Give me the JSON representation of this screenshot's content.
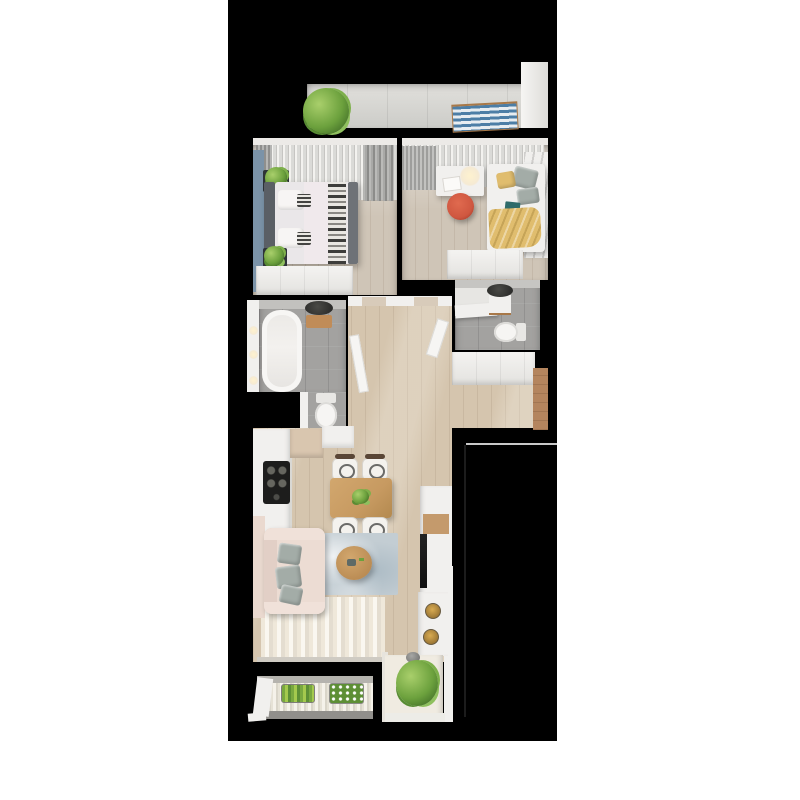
{
  "canvas": {
    "width": 800,
    "height": 800,
    "page_background": "#ffffff",
    "render_background": "#000000"
  },
  "scene": {
    "type": "3d-apartment-floor-plan-render",
    "view": "top-down",
    "rooms": [
      {
        "name": "top balcony",
        "features": [
          "concrete floor",
          "potted plant",
          "blue striped sun lounger",
          "white end wall"
        ]
      },
      {
        "name": "bedroom",
        "features": [
          "curtained window wall",
          "blue accent wall",
          "double bed with patterned runner",
          "two dark nightstands with plants",
          "white wardrobe"
        ]
      },
      {
        "name": "home office guest room",
        "features": [
          "curtained window wall",
          "white desk with lamp and open book",
          "red chair",
          "daybed with gray and yellow pillows",
          "yellow blanket",
          "marble wall",
          "white wardrobe"
        ]
      },
      {
        "name": "bathroom",
        "features": [
          "gray tile floor",
          "bathtub",
          "dark round sink with wooden shelf",
          "toilet alcove",
          "three wall sconces"
        ]
      },
      {
        "name": "wc",
        "features": [
          "gray tile floor",
          "shower tray",
          "white counter",
          "dark round sink",
          "toilet"
        ]
      },
      {
        "name": "hallway",
        "features": [
          "wood floor",
          "two open white doors",
          "doorway thresholds"
        ]
      },
      {
        "name": "entry",
        "features": [
          "white wardrobe",
          "wood panel wall"
        ]
      },
      {
        "name": "kitchen living room",
        "features": [
          "white kitchen counter with black cooktop",
          "beige upper cabinets",
          "wooden dining table with four chairs",
          "pink sofa with gray pillows",
          "blue gray rug",
          "round wooden coffee table",
          "white tv wall unit with tv",
          "striped runner rug",
          "white console with two brass stools",
          "large potted plant in white nook"
        ]
      },
      {
        "name": "bottom balcony",
        "features": [
          "striped decking",
          "green herb planter",
          "white flower planter"
        ]
      }
    ],
    "outline_annotation": "faint gray outline of unlit terrace at lower right"
  },
  "palette": {
    "background": "#000000",
    "page": "#ffffff",
    "wood_floor": "#d5c5ae",
    "wood_floor_bedroom": "#cfc5b7",
    "tile_gray": "#a3a2a0",
    "wall_white": "#f1f0ee",
    "accent_blue_wall": "#7b93a8",
    "sofa_pink": "#ecdcd3",
    "chair_red": "#cf5740",
    "textile_yellow": "#e0bd6e",
    "rug_blue_gray": "#c3cdd3",
    "table_wood": "#c79a61",
    "lounger_blue": "#4d7ea6",
    "plant_green": "#6ca13d",
    "wood_wall_brown": "#b4855e"
  }
}
